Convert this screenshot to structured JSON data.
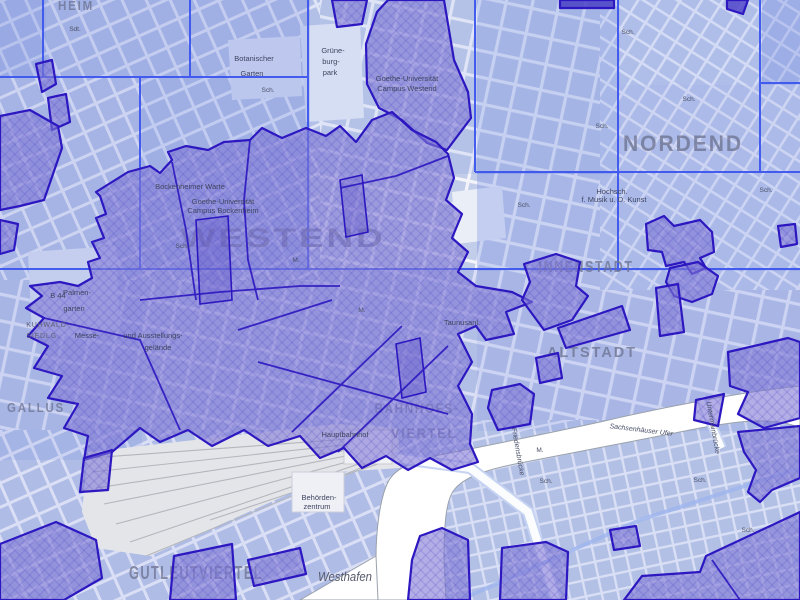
{
  "map": {
    "district_labels": {
      "heim": "HEIM",
      "westend": "WESTEND",
      "nordend": "NORDEND",
      "innenstadt": "INNENSTADT",
      "altstadt": "ALTSTADT",
      "gallus": "GALLUS",
      "bahnhofs": "BAHNHOFS-",
      "viertel": "VIERTEL",
      "gutleutviertel": "GUTLEUTVIERTEL"
    },
    "place_labels": {
      "botanischer1": "Botanischer",
      "botanischer2": "Garten",
      "grueneburg1": "Grüne-",
      "grueneburg2": "burg-",
      "grueneburg3": "park",
      "palmengarten1": "Palmen-",
      "palmengarten2": "garten",
      "uni_westend1": "Goethe-Universität",
      "uni_westend2": "Campus Westend",
      "uni_bockenheim1": "Goethe-Universität",
      "uni_bockenheim2": "Campus Bockenheim",
      "bockenheimer_warte": "Bockenheimer Warte",
      "messe1": "Messe-",
      "messe2": "und Ausstellungs-",
      "messe3": "gelände",
      "kuhwald1": "KUHWALD-",
      "kuhwald2": "SIEDLG.",
      "hochschule1": "Hochsch.",
      "hochschule2": "f. Musik u. D. Kunst",
      "behoerden1": "Behörden-",
      "behoerden2": "zentrum",
      "westhafen": "Westhafen",
      "hauptbahnhof": "Hauptbahnhof",
      "taunusanlage": "Taunusanl.",
      "b44": "B 44"
    },
    "street_labels": {
      "sachsenhaeuser_ufer": "Sachsenhäuser Ufer",
      "friedensbruecke": "Friedensbrücke",
      "untermainbruecke": "Untermainbrücke"
    },
    "abbrev": {
      "sch": "Sch.",
      "m": "M.",
      "sdt": "Sdt."
    }
  },
  "colors": {
    "overlay_fill": "#8078d5",
    "overlay_border": "#2d17c0",
    "tile_grid_blue": "#3d57ef",
    "base_block_blue": "#b9c5e6",
    "water_white": "#ffffff",
    "railway_gray": "#b4b6bd",
    "district_label_gray": "#6e7492"
  }
}
